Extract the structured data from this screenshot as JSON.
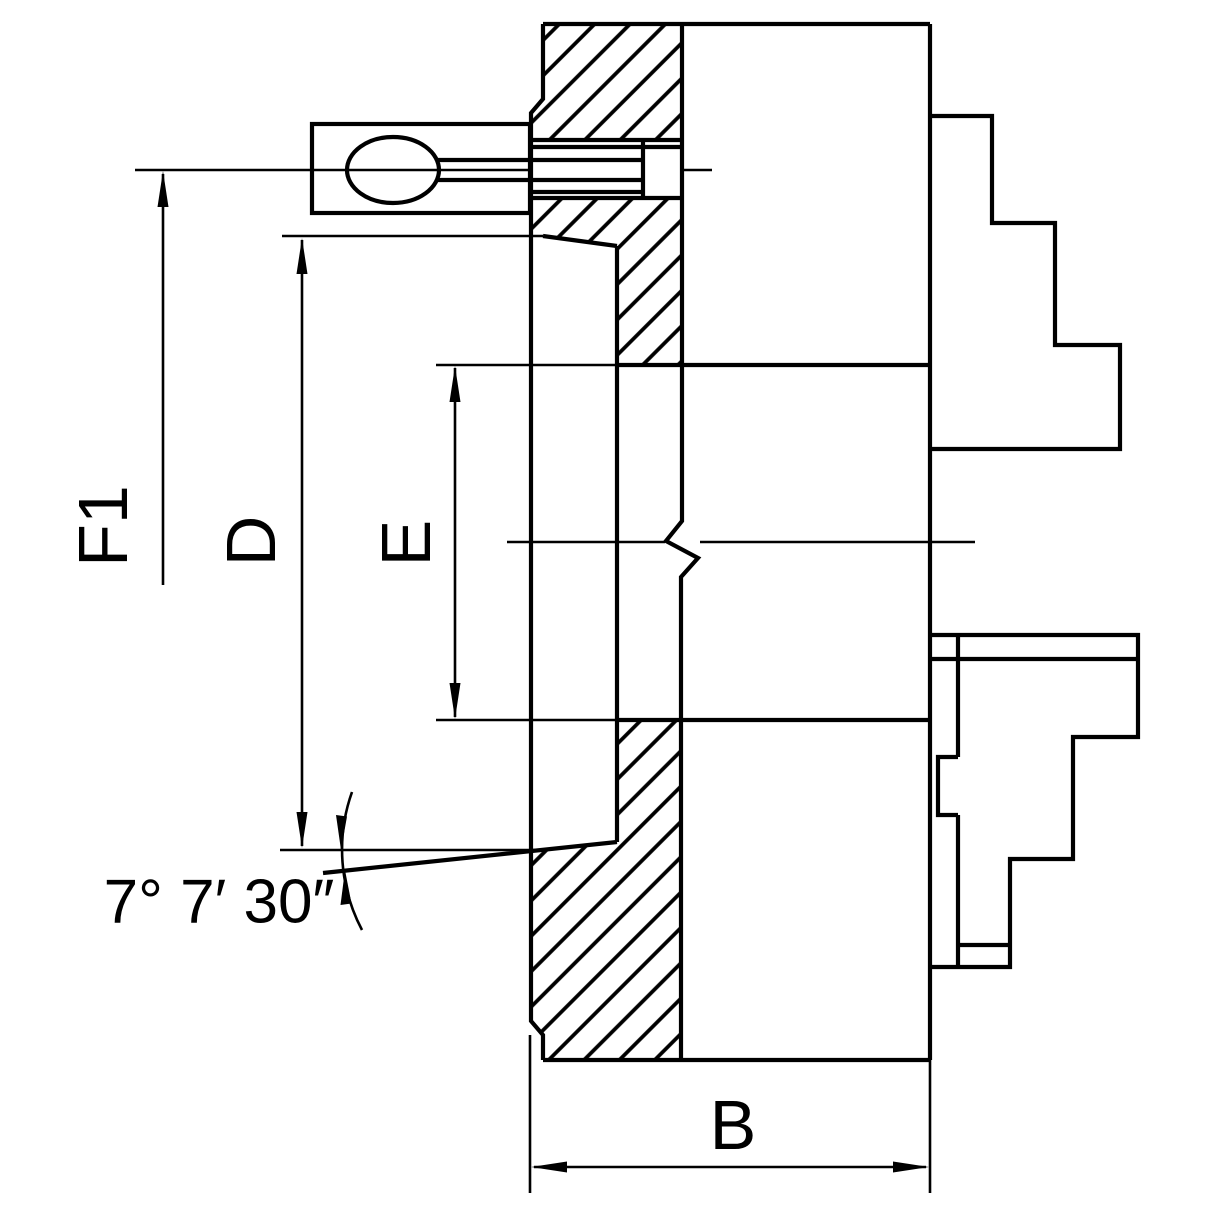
{
  "drawing": {
    "background_color": "#ffffff",
    "ink_color": "#000000",
    "labels": {
      "f1": "F1",
      "d": "D",
      "e": "E",
      "b": "B",
      "taper_angle": "7° 7′ 30″"
    }
  }
}
